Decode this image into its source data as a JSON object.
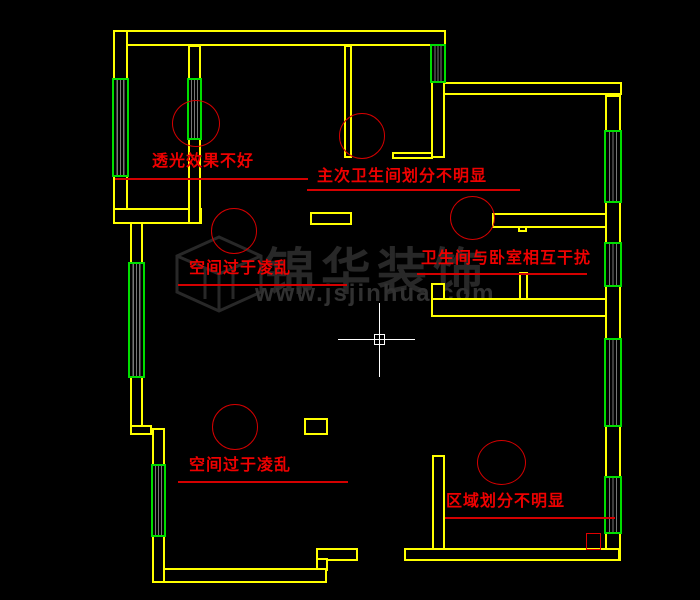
{
  "drawing": {
    "kind": "apartment floor plan review (CAD canvas)",
    "colors": {
      "background": "#000000",
      "wall": "#ffff00",
      "window_frame": "#00dd00",
      "window_glass": "#777777",
      "annotation_text": "#ee0000",
      "annotation_line": "#d40000",
      "watermark": "#2a2a2a",
      "crosshair": "#ffffff"
    }
  },
  "annotations": {
    "top_left": {
      "label": "透光效果不好"
    },
    "top_middle": {
      "label": "主次卫生间划分不明显"
    },
    "middle_left": {
      "label": "空间过于凌乱"
    },
    "middle_right": {
      "label": "卫生间与卧室相互干扰"
    },
    "bottom_left": {
      "label": "空间过于凌乱"
    },
    "bottom_right": {
      "label": "区域划分不明显"
    }
  },
  "watermark": {
    "name": "锦华装饰",
    "url": "www.jsjinhua.com"
  }
}
